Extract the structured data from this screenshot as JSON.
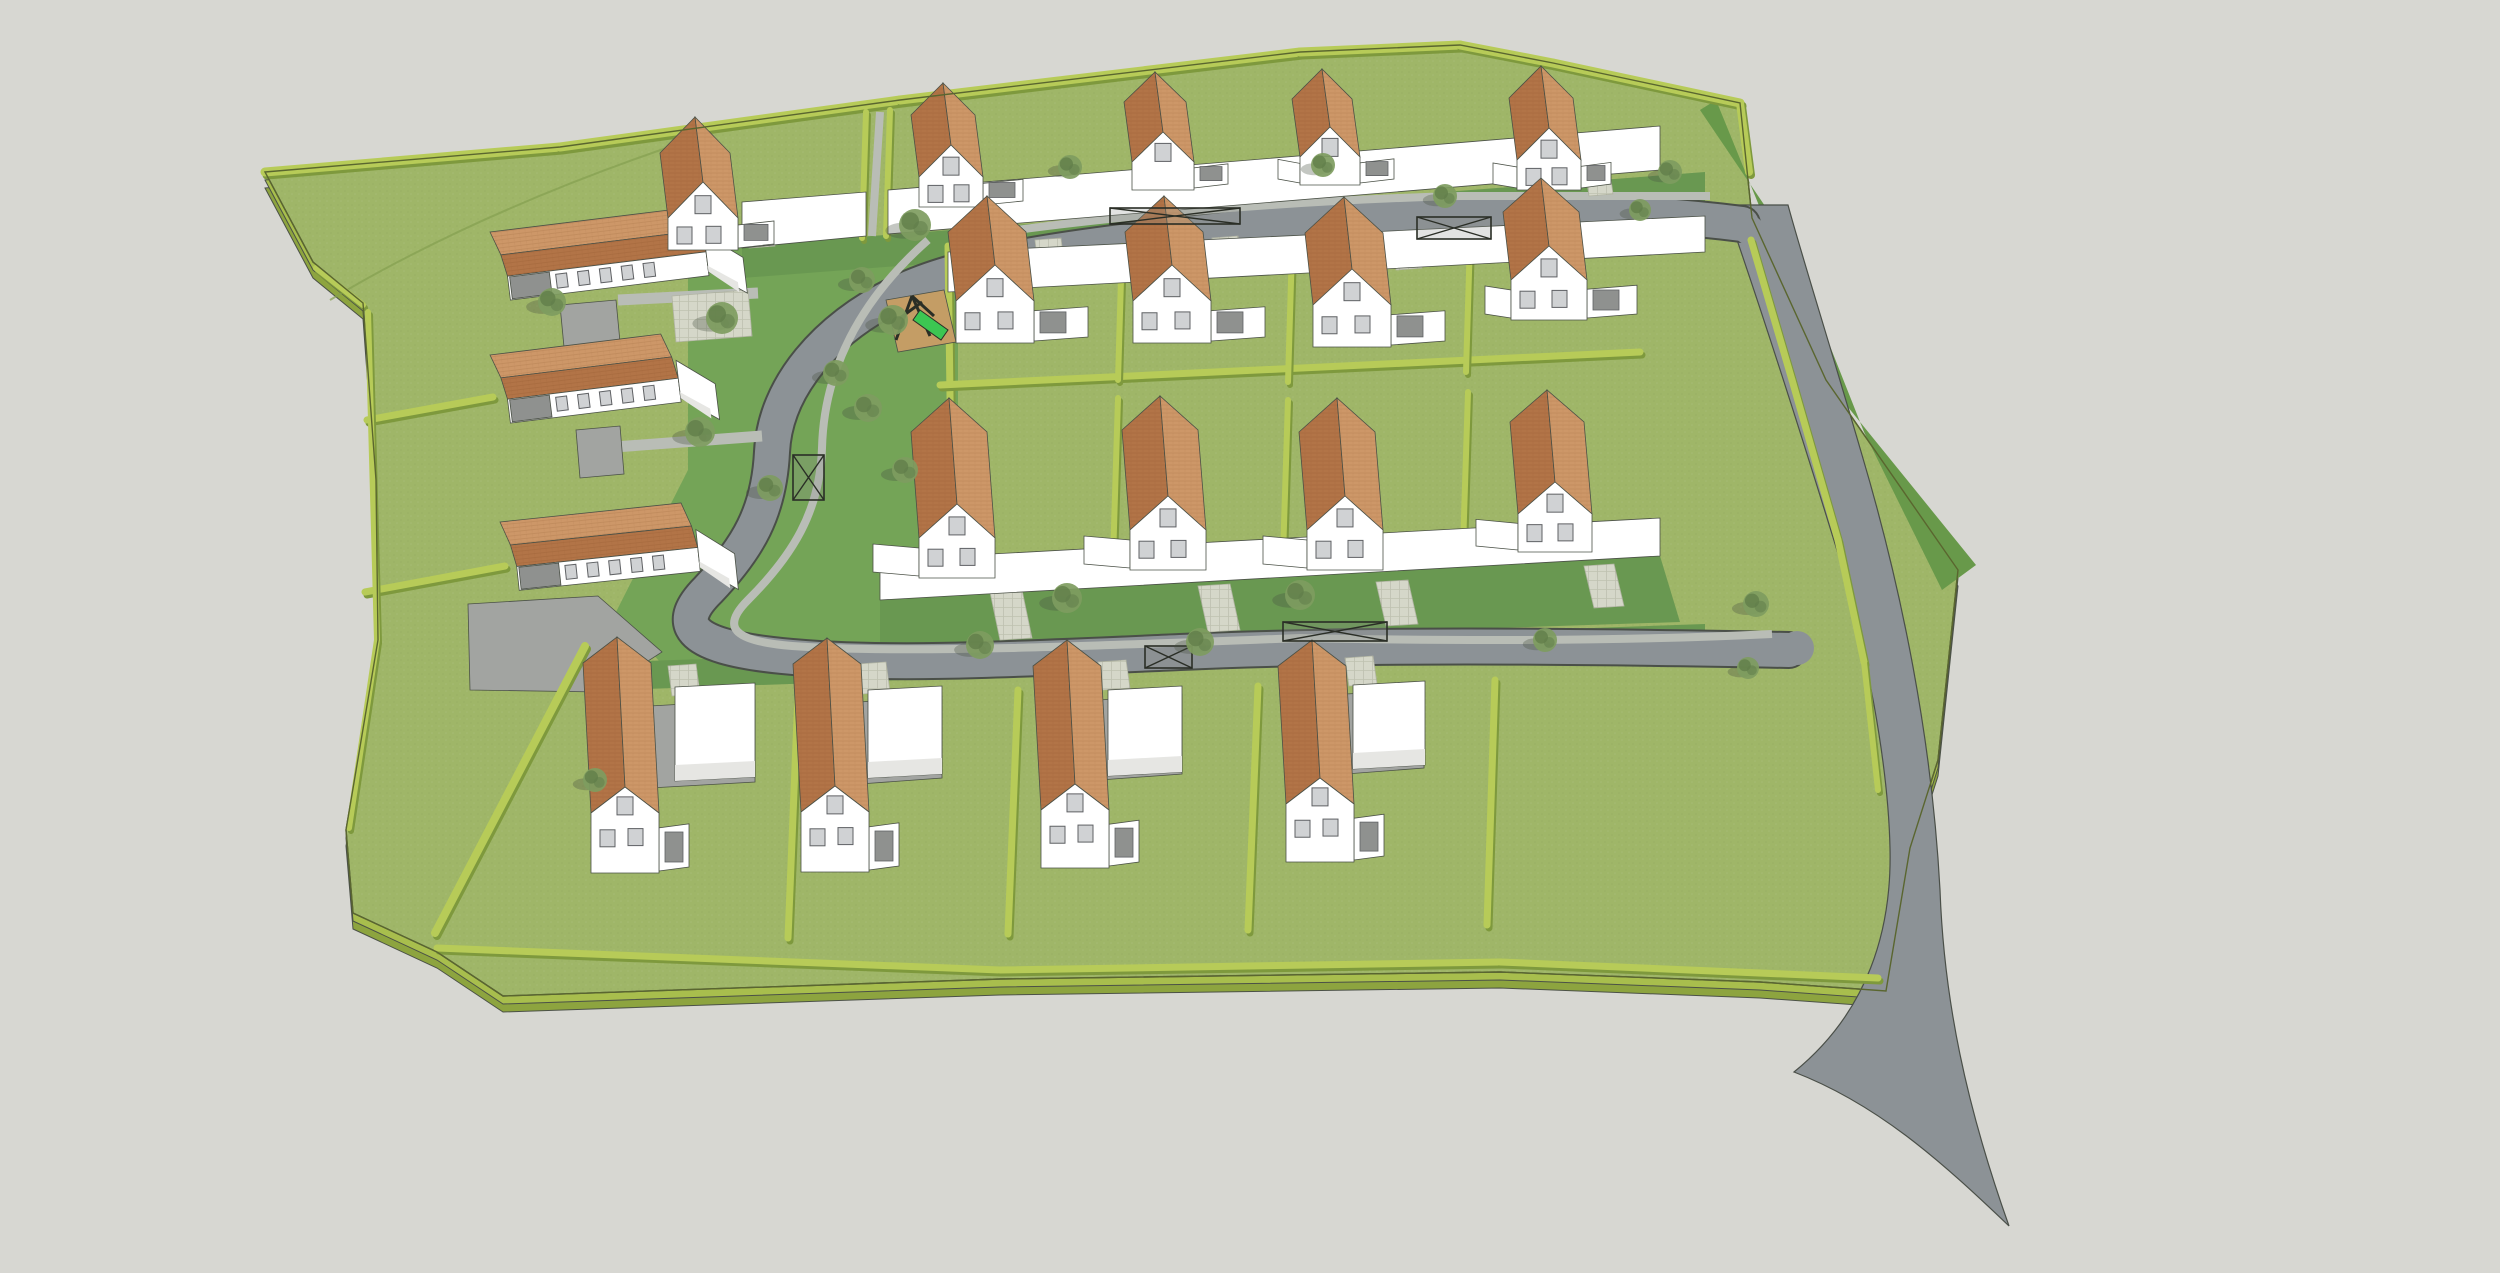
{
  "meta": {
    "kind": "3d-site-plan-render",
    "width": 2500,
    "height": 1273
  },
  "palette": {
    "bg": "#d7d7d2",
    "lawn": "#9fb668",
    "front_green": "#699851",
    "public_green": "#74a457",
    "road": "#8c9296",
    "road_edge": "#4a4f48",
    "sidewalk": "#b9bdb6",
    "paver": "#d5d7c9",
    "paver_edge": "#b2b5a4",
    "hedge": "#b7cb58",
    "hedge_dark": "#7e993d",
    "slab_side": "#a8be4d",
    "slab_side_dark": "#8da43f",
    "verge_dark": "#68994a",
    "wall": "#ffffff",
    "wall_shade": "#e6e6e3",
    "court": "#a2a4a1",
    "door": "#8f918f",
    "roof_light": "#cd9768",
    "roof_dark": "#b27447",
    "roof_row": "#ca9164",
    "window": "#d0d2d4",
    "window_frame": "#5f6164",
    "outline": "#4b5147",
    "sand": "#c49d65",
    "slide": "#3cc652",
    "frame_dark": "#2a2e26",
    "tree": "#7e9c60",
    "tree_dark": "#617e4a",
    "tree_shadow": "rgba(70,80,65,0.32)"
  },
  "site": {
    "outline": [
      [
        265,
        172
      ],
      [
        560,
        147
      ],
      [
        900,
        100
      ],
      [
        1300,
        52
      ],
      [
        1460,
        45
      ],
      [
        1553,
        63
      ],
      [
        1740,
        103
      ],
      [
        1752,
        218
      ],
      [
        1826,
        380
      ],
      [
        1958,
        570
      ],
      [
        1938,
        760
      ],
      [
        1910,
        848
      ],
      [
        1886,
        991
      ],
      [
        1760,
        982
      ],
      [
        1500,
        972
      ],
      [
        1000,
        979
      ],
      [
        503,
        996
      ],
      [
        437,
        952
      ],
      [
        353,
        913
      ],
      [
        346,
        830
      ],
      [
        378,
        640
      ],
      [
        376,
        480
      ],
      [
        363,
        303
      ],
      [
        313,
        262
      ]
    ],
    "slab_offsets": [
      16,
      8
    ],
    "field_curve": "M330,300 Q480,210 690,140",
    "public_green": [
      [
        688,
        248
      ],
      [
        958,
        238
      ],
      [
        958,
        600
      ],
      [
        920,
        642
      ],
      [
        660,
        662
      ],
      [
        616,
        612
      ],
      [
        688,
        470
      ]
    ],
    "front_strips": [
      [
        [
          742,
          246
        ],
        [
          1705,
          172
        ],
        [
          1705,
          204
        ],
        [
          742,
          278
        ]
      ],
      [
        [
          880,
          598
        ],
        [
          1660,
          556
        ],
        [
          1680,
          622
        ],
        [
          880,
          648
        ]
      ],
      [
        [
          618,
          662
        ],
        [
          1705,
          624
        ],
        [
          1705,
          652
        ],
        [
          618,
          690
        ]
      ]
    ]
  },
  "roads": {
    "verge_dark": [
      [
        1716,
        100
      ],
      [
        1760,
        208
      ],
      [
        1826,
        380
      ],
      [
        1976,
        565
      ],
      [
        1942,
        590
      ],
      [
        1864,
        432
      ],
      [
        1788,
        240
      ],
      [
        1700,
        110
      ]
    ],
    "access_road": "M1725,205 C1758,300 1800,430 1840,560 C1866,650 1888,760 1890,848 C1892,930 1868,1012 1794,1072 C1880,1105 1945,1165 2009,1226 C1966,1105 1944,1000 1940,890 C1932,740 1902,590 1862,455 C1830,345 1800,250 1788,205 Z",
    "loop_center": "M1742,224 C1600,206 1430,206 1240,228 C1090,245 975,258 905,290 C825,327 775,388 772,452 C769,512 748,548 708,590 C676,622 682,646 782,656 C882,666 1000,660 1180,652 C1360,644 1560,646 1789,650",
    "loop_width": 34,
    "loop_casing": 38,
    "fillets": [
      [
        1749,
        230,
        15
      ],
      [
        1797,
        648,
        17
      ]
    ],
    "sidewalks": [
      "M928,240 C860,300 824,370 822,448 C820,512 792,556 748,600 C722,626 730,641 792,646 C900,654 1100,646 1300,638 C1500,642 1650,640 1772,634",
      "M962,238 C1100,216 1300,200 1460,196 L1710,196",
      "M880,112 L872,236"
    ],
    "lanes": [
      [
        618,
        300,
        758,
        293,
        11
      ],
      [
        615,
        447,
        762,
        436,
        11
      ]
    ],
    "courts": [
      [
        [
          560,
          305
        ],
        [
          616,
          300
        ],
        [
          620,
          342
        ],
        [
          564,
          347
        ]
      ],
      [
        [
          576,
          430
        ],
        [
          620,
          426
        ],
        [
          624,
          474
        ],
        [
          580,
          478
        ]
      ],
      [
        [
          468,
          604
        ],
        [
          598,
          596
        ],
        [
          662,
          652
        ],
        [
          600,
          692
        ],
        [
          470,
          690
        ]
      ],
      [
        [
          650,
          706
        ],
        [
          755,
          700
        ],
        [
          755,
          782
        ],
        [
          650,
          788
        ]
      ],
      [
        [
          860,
          702
        ],
        [
          942,
          696
        ],
        [
          942,
          778
        ],
        [
          860,
          784
        ]
      ],
      [
        [
          1100,
          700
        ],
        [
          1182,
          694
        ],
        [
          1182,
          774
        ],
        [
          1100,
          780
        ]
      ],
      [
        [
          1346,
          694
        ],
        [
          1424,
          690
        ],
        [
          1424,
          768
        ],
        [
          1346,
          774
        ]
      ]
    ],
    "pavers": [
      [
        [
          672,
          296
        ],
        [
          748,
          290
        ],
        [
          752,
          336
        ],
        [
          676,
          342
        ]
      ],
      [
        [
          990,
          592
        ],
        [
          1022,
          590
        ],
        [
          1032,
          638
        ],
        [
          1000,
          640
        ]
      ],
      [
        [
          1198,
          586
        ],
        [
          1230,
          584
        ],
        [
          1240,
          630
        ],
        [
          1208,
          632
        ]
      ],
      [
        [
          1376,
          582
        ],
        [
          1408,
          580
        ],
        [
          1418,
          624
        ],
        [
          1386,
          626
        ]
      ],
      [
        [
          1584,
          566
        ],
        [
          1614,
          564
        ],
        [
          1624,
          606
        ],
        [
          1594,
          608
        ]
      ],
      [
        [
          1035,
          240
        ],
        [
          1061,
          238
        ],
        [
          1065,
          272
        ],
        [
          1039,
          274
        ]
      ],
      [
        [
          1212,
          238
        ],
        [
          1238,
          236
        ],
        [
          1242,
          268
        ],
        [
          1216,
          270
        ]
      ],
      [
        [
          1392,
          240
        ],
        [
          1418,
          238
        ],
        [
          1422,
          268
        ],
        [
          1396,
          270
        ]
      ],
      [
        [
          745,
          218
        ],
        [
          771,
          216
        ],
        [
          775,
          246
        ],
        [
          749,
          248
        ]
      ],
      [
        [
          990,
          182
        ],
        [
          1014,
          180
        ],
        [
          1018,
          208
        ],
        [
          994,
          210
        ]
      ],
      [
        [
          1195,
          166
        ],
        [
          1219,
          164
        ],
        [
          1223,
          192
        ],
        [
          1199,
          194
        ]
      ],
      [
        [
          1360,
          160
        ],
        [
          1384,
          158
        ],
        [
          1388,
          186
        ],
        [
          1364,
          188
        ]
      ],
      [
        [
          1585,
          168
        ],
        [
          1609,
          166
        ],
        [
          1613,
          194
        ],
        [
          1589,
          196
        ]
      ],
      [
        [
          668,
          666
        ],
        [
          696,
          664
        ],
        [
          700,
          694
        ],
        [
          672,
          696
        ]
      ],
      [
        [
          858,
          664
        ],
        [
          886,
          662
        ],
        [
          890,
          692
        ],
        [
          862,
          694
        ]
      ],
      [
        [
          1098,
          662
        ],
        [
          1126,
          660
        ],
        [
          1130,
          688
        ],
        [
          1102,
          690
        ]
      ],
      [
        [
          1345,
          658
        ],
        [
          1373,
          656
        ],
        [
          1377,
          684
        ],
        [
          1349,
          686
        ]
      ]
    ]
  },
  "hedges": [
    [
      265,
      172,
      560,
      147,
      9
    ],
    [
      560,
      147,
      900,
      100,
      9
    ],
    [
      900,
      100,
      1300,
      52,
      9
    ],
    [
      1300,
      52,
      1460,
      45,
      9
    ],
    [
      1460,
      45,
      1553,
      63,
      9
    ],
    [
      1553,
      63,
      1740,
      103,
      9
    ],
    [
      1740,
      103,
      1749,
      172,
      8
    ],
    [
      1751,
      240,
      1792,
      380,
      7
    ],
    [
      1792,
      380,
      1838,
      540,
      7
    ],
    [
      1838,
      540,
      1864,
      662,
      7
    ],
    [
      1864,
      662,
      1878,
      790,
      6
    ],
    [
      948,
      246,
      952,
      545,
      7
    ],
    [
      866,
      112,
      862,
      238,
      6
    ],
    [
      890,
      110,
      886,
      236,
      6
    ],
    [
      940,
      385,
      1640,
      352,
      7
    ],
    [
      1122,
      246,
      1118,
      380,
      6
    ],
    [
      1292,
      248,
      1288,
      382,
      6
    ],
    [
      1470,
      240,
      1466,
      372,
      6
    ],
    [
      1118,
      398,
      1113,
      560,
      6
    ],
    [
      1288,
      400,
      1283,
      556,
      6
    ],
    [
      1468,
      392,
      1463,
      548,
      6
    ],
    [
      798,
      694,
      788,
      938,
      7
    ],
    [
      1018,
      690,
      1008,
      934,
      7
    ],
    [
      1258,
      686,
      1248,
      930,
      7
    ],
    [
      1495,
      680,
      1487,
      925,
      7
    ],
    [
      437,
      948,
      1000,
      970,
      7
    ],
    [
      1000,
      970,
      1500,
      962,
      7
    ],
    [
      1500,
      962,
      1878,
      978,
      7
    ],
    [
      585,
      646,
      435,
      933,
      8
    ],
    [
      367,
      420,
      493,
      397,
      7
    ],
    [
      365,
      592,
      505,
      566,
      7
    ],
    [
      316,
      268,
      363,
      305,
      6
    ],
    [
      368,
      312,
      377,
      640,
      6
    ],
    [
      377,
      640,
      349,
      828,
      6
    ]
  ],
  "white_bands": [
    [
      [
        742,
        202
      ],
      [
        866,
        192
      ],
      [
        866,
        236
      ],
      [
        742,
        248
      ]
    ],
    [
      [
        888,
        190
      ],
      [
        1660,
        126
      ],
      [
        1660,
        170
      ],
      [
        888,
        234
      ]
    ],
    [
      [
        948,
        252
      ],
      [
        1705,
        216
      ],
      [
        1705,
        252
      ],
      [
        948,
        292
      ]
    ],
    [
      [
        880,
        560
      ],
      [
        1660,
        518
      ],
      [
        1660,
        556
      ],
      [
        880,
        600
      ]
    ]
  ],
  "row_houses": [
    {
      "x": 490,
      "y": 232,
      "len": 200,
      "rot": -7
    },
    {
      "x": 490,
      "y": 355,
      "len": 172,
      "rot": -7
    },
    {
      "x": 500,
      "y": 522,
      "len": 182,
      "rot": -6
    }
  ],
  "houses": {
    "legend": "cx, wallBottomY, gableWidth, wallH, peakH, ridgeLen, wingRight, wingLeft",
    "row_a": [
      [
        703,
        250,
        70,
        32,
        36,
        65,
        36,
        0
      ],
      [
        951,
        207,
        64,
        30,
        32,
        62,
        40,
        0
      ],
      [
        1163,
        190,
        62,
        28,
        30,
        60,
        34,
        0
      ],
      [
        1330,
        185,
        60,
        28,
        30,
        58,
        34,
        22
      ],
      [
        1549,
        190,
        64,
        30,
        32,
        62,
        30,
        24
      ]
    ],
    "row_b": [
      [
        995,
        343,
        78,
        42,
        36,
        69,
        54,
        0
      ],
      [
        1172,
        343,
        78,
        42,
        36,
        69,
        54,
        0
      ],
      [
        1352,
        347,
        78,
        42,
        36,
        72,
        54,
        0
      ],
      [
        1549,
        320,
        76,
        40,
        34,
        68,
        50,
        26
      ]
    ],
    "row_c": [
      [
        957,
        578,
        76,
        40,
        34,
        106,
        0,
        46
      ],
      [
        1168,
        570,
        76,
        40,
        34,
        100,
        0,
        46
      ],
      [
        1345,
        570,
        76,
        40,
        34,
        98,
        0,
        44
      ],
      [
        1555,
        552,
        74,
        38,
        32,
        92,
        0,
        42
      ]
    ],
    "row_d": [
      [
        625,
        873,
        68,
        60,
        26,
        150,
        30,
        0
      ],
      [
        835,
        872,
        68,
        60,
        26,
        148,
        30,
        0
      ],
      [
        1075,
        868,
        68,
        58,
        26,
        144,
        30,
        0
      ],
      [
        1320,
        862,
        68,
        58,
        26,
        138,
        30,
        0
      ]
    ]
  },
  "garages_d": [
    [
      675,
      687,
      80,
      94
    ],
    [
      868,
      690,
      74,
      88
    ],
    [
      1108,
      690,
      74,
      86
    ],
    [
      1353,
      685,
      72,
      84
    ]
  ],
  "bike_shelters": [
    [
      1110,
      208,
      130,
      16
    ],
    [
      1417,
      217,
      74,
      22
    ],
    [
      1283,
      622,
      104,
      19
    ],
    [
      1145,
      646,
      47,
      22
    ],
    [
      793,
      455,
      31,
      45
    ]
  ],
  "playground": {
    "sand": [
      [
        886,
        300
      ],
      [
        944,
        290
      ],
      [
        956,
        342
      ],
      [
        898,
        352
      ]
    ],
    "poles": [
      [
        896,
        340,
        912,
        296
      ],
      [
        930,
        336,
        912,
        296
      ],
      [
        912,
        296,
        934,
        316
      ],
      [
        900,
        318,
        922,
        302
      ]
    ],
    "slide": [
      [
        920,
        310
      ],
      [
        948,
        330
      ],
      [
        941,
        340
      ],
      [
        913,
        320
      ]
    ]
  },
  "trees": [
    [
      915,
      225,
      16
    ],
    [
      862,
      280,
      13
    ],
    [
      893,
      320,
      15
    ],
    [
      836,
      373,
      13
    ],
    [
      868,
      408,
      14
    ],
    [
      905,
      470,
      13
    ],
    [
      700,
      432,
      15
    ],
    [
      722,
      318,
      16
    ],
    [
      552,
      302,
      14
    ],
    [
      770,
      488,
      13
    ],
    [
      980,
      645,
      14
    ],
    [
      1067,
      598,
      15
    ],
    [
      1300,
      595,
      15
    ],
    [
      1200,
      642,
      14
    ],
    [
      1545,
      640,
      12
    ],
    [
      1445,
      196,
      12
    ],
    [
      1323,
      165,
      12
    ],
    [
      1070,
      167,
      12
    ],
    [
      1670,
      172,
      12
    ],
    [
      1640,
      210,
      11
    ],
    [
      1756,
      604,
      13
    ],
    [
      1748,
      668,
      11
    ],
    [
      595,
      780,
      12
    ]
  ]
}
